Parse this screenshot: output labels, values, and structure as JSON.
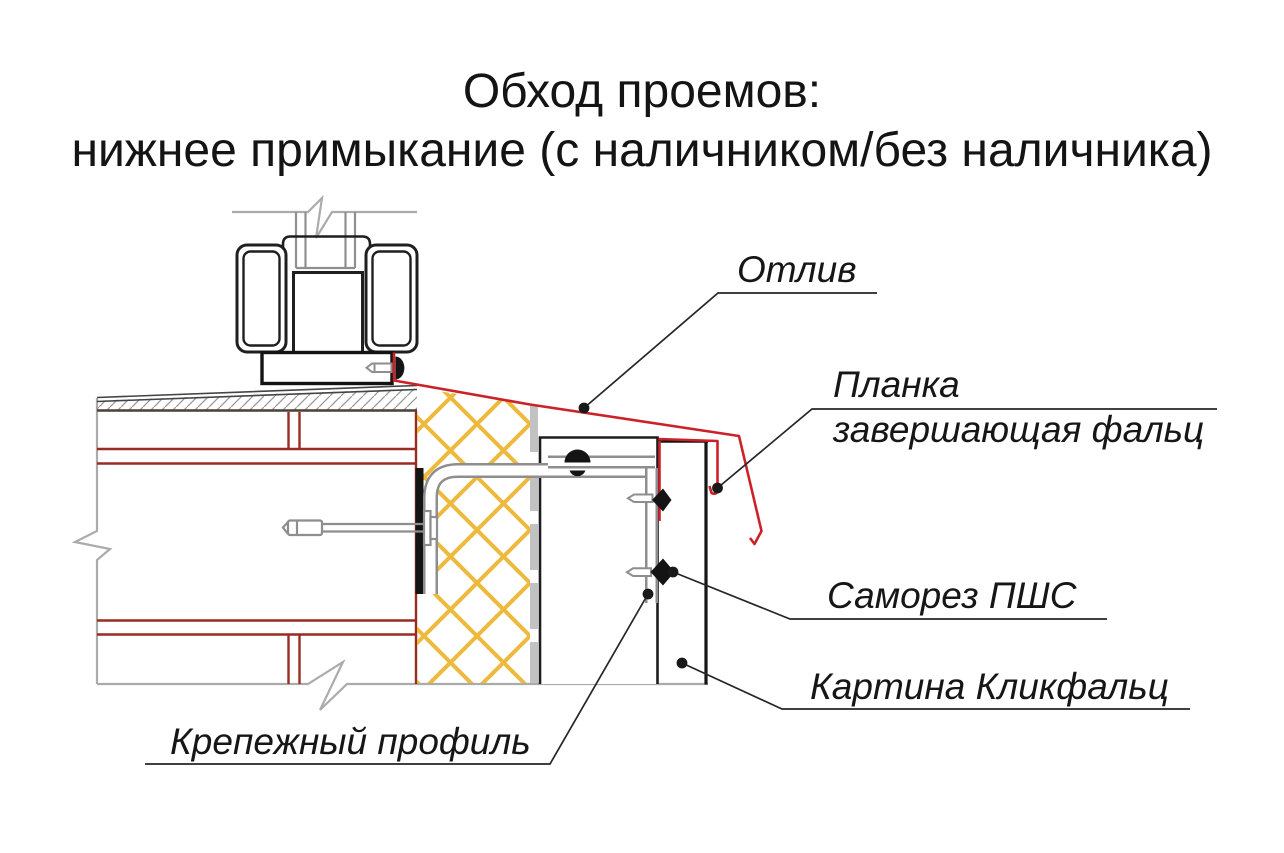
{
  "title": {
    "line1": "Обход проемов:",
    "line2": "нижнее примыкание (с наличником/без наличника)"
  },
  "labels": {
    "otliv": "Отлив",
    "planka_line1": "Планка",
    "planka_line2": "завершающая фальц",
    "samorez": "Саморез ПШС",
    "kartina": "Картина Кликфальц",
    "krepezh": "Крепежный профиль"
  },
  "colors": {
    "flashing_red": "#CB2228",
    "brick_red": "#9A2B23",
    "insulation_yellow": "#EDBA3E",
    "outline_gray": "#ABABAB",
    "steel_gray": "#8E8E8E",
    "ink": "#1A1A1A"
  }
}
